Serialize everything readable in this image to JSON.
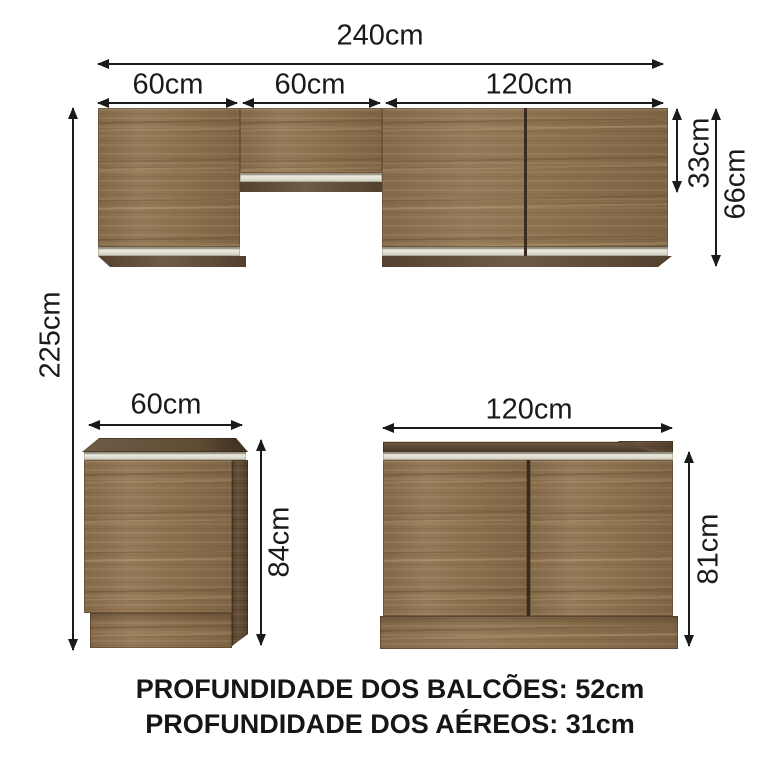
{
  "dimensions": {
    "top_total": "240cm",
    "top_sections": [
      "60cm",
      "60cm",
      "120cm"
    ],
    "upper_height_small": "33cm",
    "upper_height_large": "66cm",
    "overall_height": "225cm",
    "base_left_width": "60cm",
    "base_left_height": "84cm",
    "base_right_width": "120cm",
    "base_right_height": "81cm"
  },
  "footer": {
    "line1": "PROFUNDIDADE DOS BALCÕES: 52cm",
    "line2": "PROFUNDIDADE DOS AÉREOS: 31cm"
  },
  "colors": {
    "wood": "#8e724e",
    "wood_dark": "#5e4831",
    "underside": "#66503a",
    "strip": "#e3e0d3",
    "ink": "#1a1a1a"
  }
}
